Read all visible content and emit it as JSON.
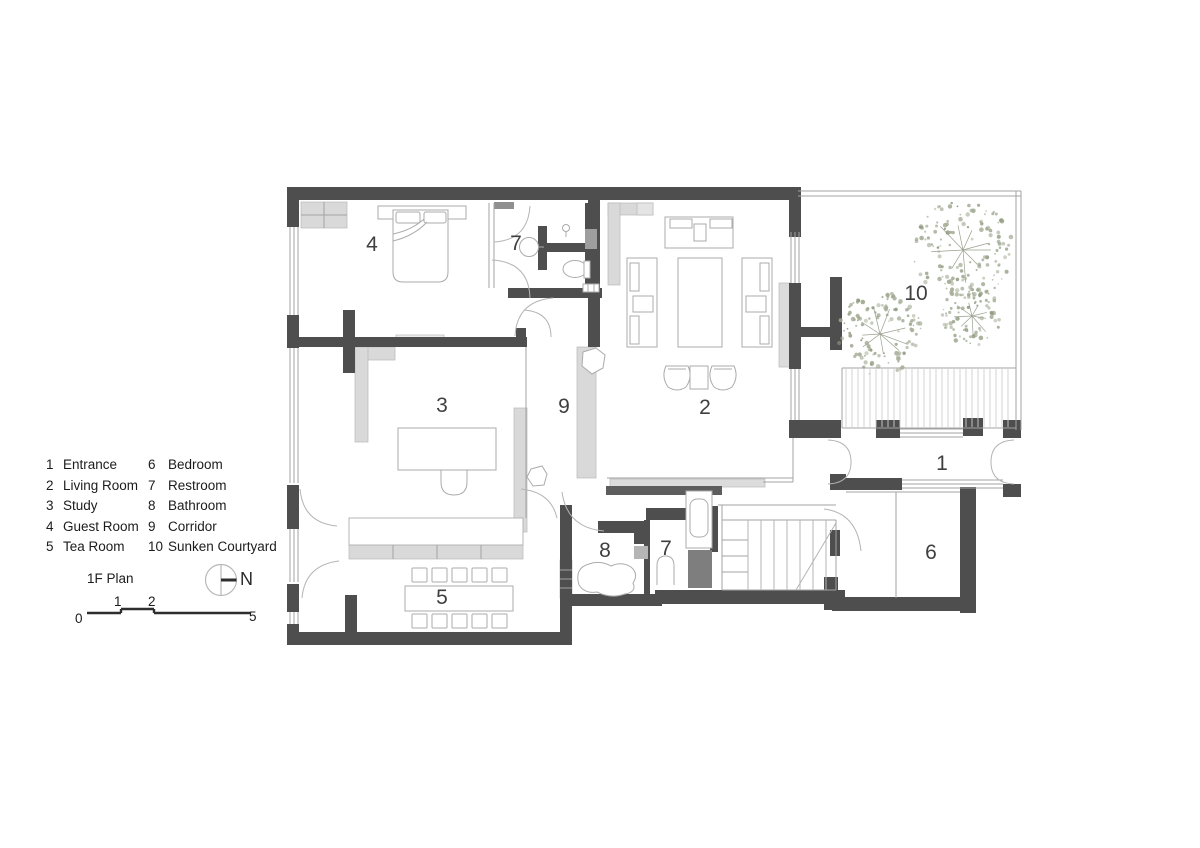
{
  "title": "1F Plan",
  "north_label": "N",
  "scale_labels": [
    "0",
    "1",
    "2",
    "5"
  ],
  "legend": {
    "col1": [
      {
        "num": "1",
        "name": "Entrance"
      },
      {
        "num": "2",
        "name": "Living Room"
      },
      {
        "num": "3",
        "name": "Study"
      },
      {
        "num": "4",
        "name": "Guest Room"
      },
      {
        "num": "5",
        "name": "Tea Room"
      }
    ],
    "col2": [
      {
        "num": "6",
        "name": "Bedroom"
      },
      {
        "num": "7",
        "name": "Restroom"
      },
      {
        "num": "8",
        "name": "Bathroom"
      },
      {
        "num": "9",
        "name": "Corridor"
      },
      {
        "num": "10",
        "name": "Sunken Courtyard"
      }
    ]
  },
  "plan": {
    "room_labels": [
      {
        "room": "entrance",
        "num": "1",
        "x": 942,
        "y": 470
      },
      {
        "room": "living-room",
        "num": "2",
        "x": 705,
        "y": 414
      },
      {
        "room": "study",
        "num": "3",
        "x": 442,
        "y": 412
      },
      {
        "room": "guest-room",
        "num": "4",
        "x": 372,
        "y": 251
      },
      {
        "room": "tea-room",
        "num": "5",
        "x": 442,
        "y": 604
      },
      {
        "room": "bedroom",
        "num": "6",
        "x": 931,
        "y": 559
      },
      {
        "room": "restroom-top",
        "num": "7",
        "x": 516,
        "y": 250
      },
      {
        "room": "restroom-lower",
        "num": "7",
        "x": 666,
        "y": 555
      },
      {
        "room": "bathroom",
        "num": "8",
        "x": 605,
        "y": 557
      },
      {
        "room": "corridor",
        "num": "9",
        "x": 564,
        "y": 413
      },
      {
        "room": "sunken-courtyard",
        "num": "10",
        "x": 916,
        "y": 300
      }
    ],
    "trees": [
      {
        "x": 963,
        "y": 250,
        "r": 50
      },
      {
        "x": 972,
        "y": 316,
        "r": 30
      },
      {
        "x": 880,
        "y": 334,
        "r": 42
      }
    ]
  },
  "colors": {
    "wall": "#4e4e4e",
    "line": "#a3a3a3",
    "door_line": "#b4b4b4",
    "light_fill": "#d9d9d9",
    "tree_foliage": "#a2ab94",
    "tree_dark": "#8f9a80",
    "text": "#3f3f3f"
  }
}
